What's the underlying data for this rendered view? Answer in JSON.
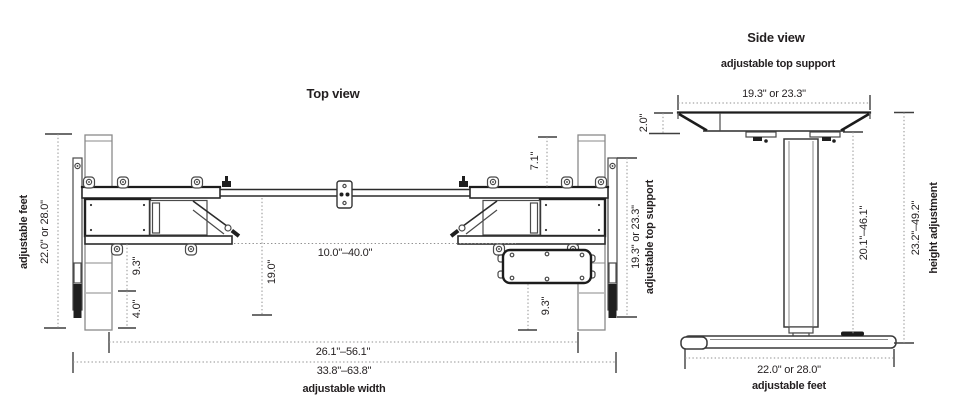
{
  "diagram": {
    "top_view": {
      "title": "Top view",
      "labels": {
        "adjustable_feet": "adjustable feet",
        "feet_depth": "22.0\" or 28.0\"",
        "foot_inset": "9.3\"",
        "foot_extension": "4.0\"",
        "frame_depth": "19.0\"",
        "crossbar_range": "10.0\"–40.0\"",
        "rail_offset": "7.1\"",
        "top_support_range": "19.3\" or 23.3\"",
        "adjustable_top_support": "adjustable top support",
        "control_box_inset": "9.3\"",
        "inner_width_range": "26.1\"–56.1\"",
        "outer_width_range": "33.8\"–63.8\"",
        "adjustable_width": "adjustable width"
      }
    },
    "side_view": {
      "title": "Side view",
      "subtitle": "adjustable top support",
      "labels": {
        "top_support_range": "19.3\" or 23.3\"",
        "top_thickness": "2.0\"",
        "column_travel": "20.1\"–46.1\"",
        "height_travel": "23.2\"–49.2\"",
        "height_adjustment": "height adjustment",
        "feet_length": "22.0\" or 28.0\"",
        "adjustable_feet": "adjustable feet"
      }
    },
    "colors": {
      "line_dark": "#1c1c1c",
      "line_light": "#8a8a8a",
      "dim_dotted": "#8f8f8f",
      "text": "#231f20",
      "background": "#ffffff"
    }
  }
}
